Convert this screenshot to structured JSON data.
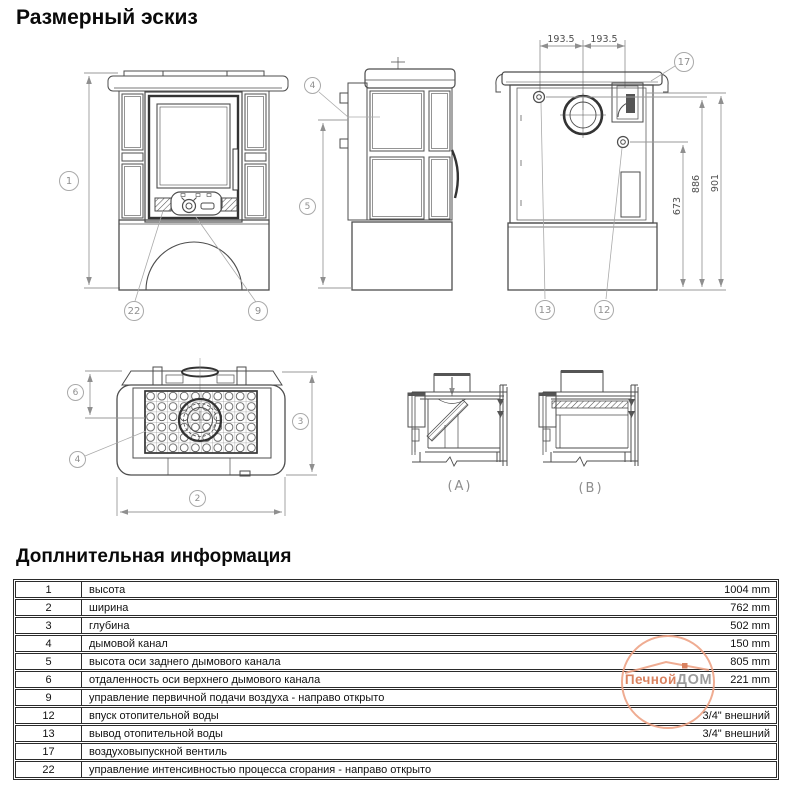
{
  "page": {
    "title": "Размерный эскиз",
    "info_title": "Доплнительная информация"
  },
  "drawing": {
    "callouts": {
      "c1": "1",
      "c22": "22",
      "c9": "9",
      "c4_side": "4",
      "c5": "5",
      "c17": "17",
      "c13": "13",
      "c12": "12",
      "c6": "6",
      "c3": "3",
      "c2": "2",
      "c4_plan": "4"
    },
    "dims": {
      "top_left": "193.5",
      "top_right": "193.5",
      "v673": "673",
      "v886": "886",
      "v901": "901"
    },
    "sections": {
      "a": "(A)",
      "b": "(B)"
    }
  },
  "watermark": {
    "part1": "Печной",
    "part2": "ДОМ",
    "accent": "#d4714b",
    "ring": "#eda183"
  },
  "table": {
    "rows": [
      {
        "num": "1",
        "desc": "высота",
        "value": "1004 mm"
      },
      {
        "num": "2",
        "desc": "ширина",
        "value": "762 mm"
      },
      {
        "num": "3",
        "desc": "глубина",
        "value": "502 mm"
      },
      {
        "num": "4",
        "desc": "дымовой канал",
        "value": "150 mm"
      },
      {
        "num": "5",
        "desc": "высота оси заднего дымового канала",
        "value": "805 mm"
      },
      {
        "num": "6",
        "desc": "отдаленность оси верхнего дымового канала",
        "value": "221 mm"
      },
      {
        "num": "9",
        "desc": "управление первичной подачи воздуха - направо открыто",
        "value": ""
      },
      {
        "num": "12",
        "desc": "впуск отопительной воды",
        "value": "3/4\" внешний"
      },
      {
        "num": "13",
        "desc": "вывод отопительной воды",
        "value": "3/4\" внешний"
      },
      {
        "num": "17",
        "desc": "воздуховыпускной вентиль",
        "value": ""
      },
      {
        "num": "22",
        "desc": "управление интенсивностью процесса сгорания - направо открыто",
        "value": ""
      }
    ]
  }
}
